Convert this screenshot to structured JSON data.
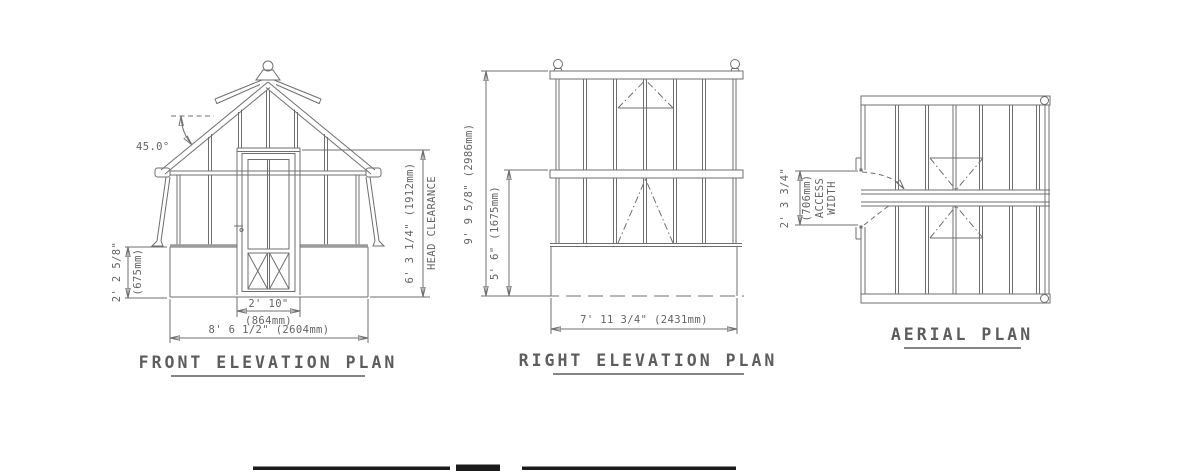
{
  "colors": {
    "line": "#6f6f6f",
    "text": "#636363",
    "title": "#5d5d5d",
    "bottom_bar": "#1b1b1b"
  },
  "front_elevation": {
    "title": "FRONT ELEVATION PLAN",
    "roof_angle": "45.0°",
    "base_height_ft": "2' 2 5/8\"",
    "base_height_mm": "(675mm)",
    "door_width_ft": "2' 10\"",
    "door_width_mm": "(864mm)",
    "overall_width": "8' 6 1/2\" (2604mm)",
    "head_clearance_dim": "6' 3 1/4\" (1912mm)",
    "head_clearance_label": "HEAD CLEARANCE"
  },
  "right_elevation": {
    "title": "RIGHT ELEVATION PLAN",
    "overall_height": "9' 9 5/8\" (2986mm)",
    "eaves_height": "5' 6\" (1675mm)",
    "overall_width": "7' 11 3/4\" (2431mm)"
  },
  "aerial_plan": {
    "title": "AERIAL PLAN",
    "access_width_ft": "2' 3 3/4\"",
    "access_width_mm": "(706mm)",
    "access_label_1": "ACCESS",
    "access_label_2": "WIDTH"
  }
}
